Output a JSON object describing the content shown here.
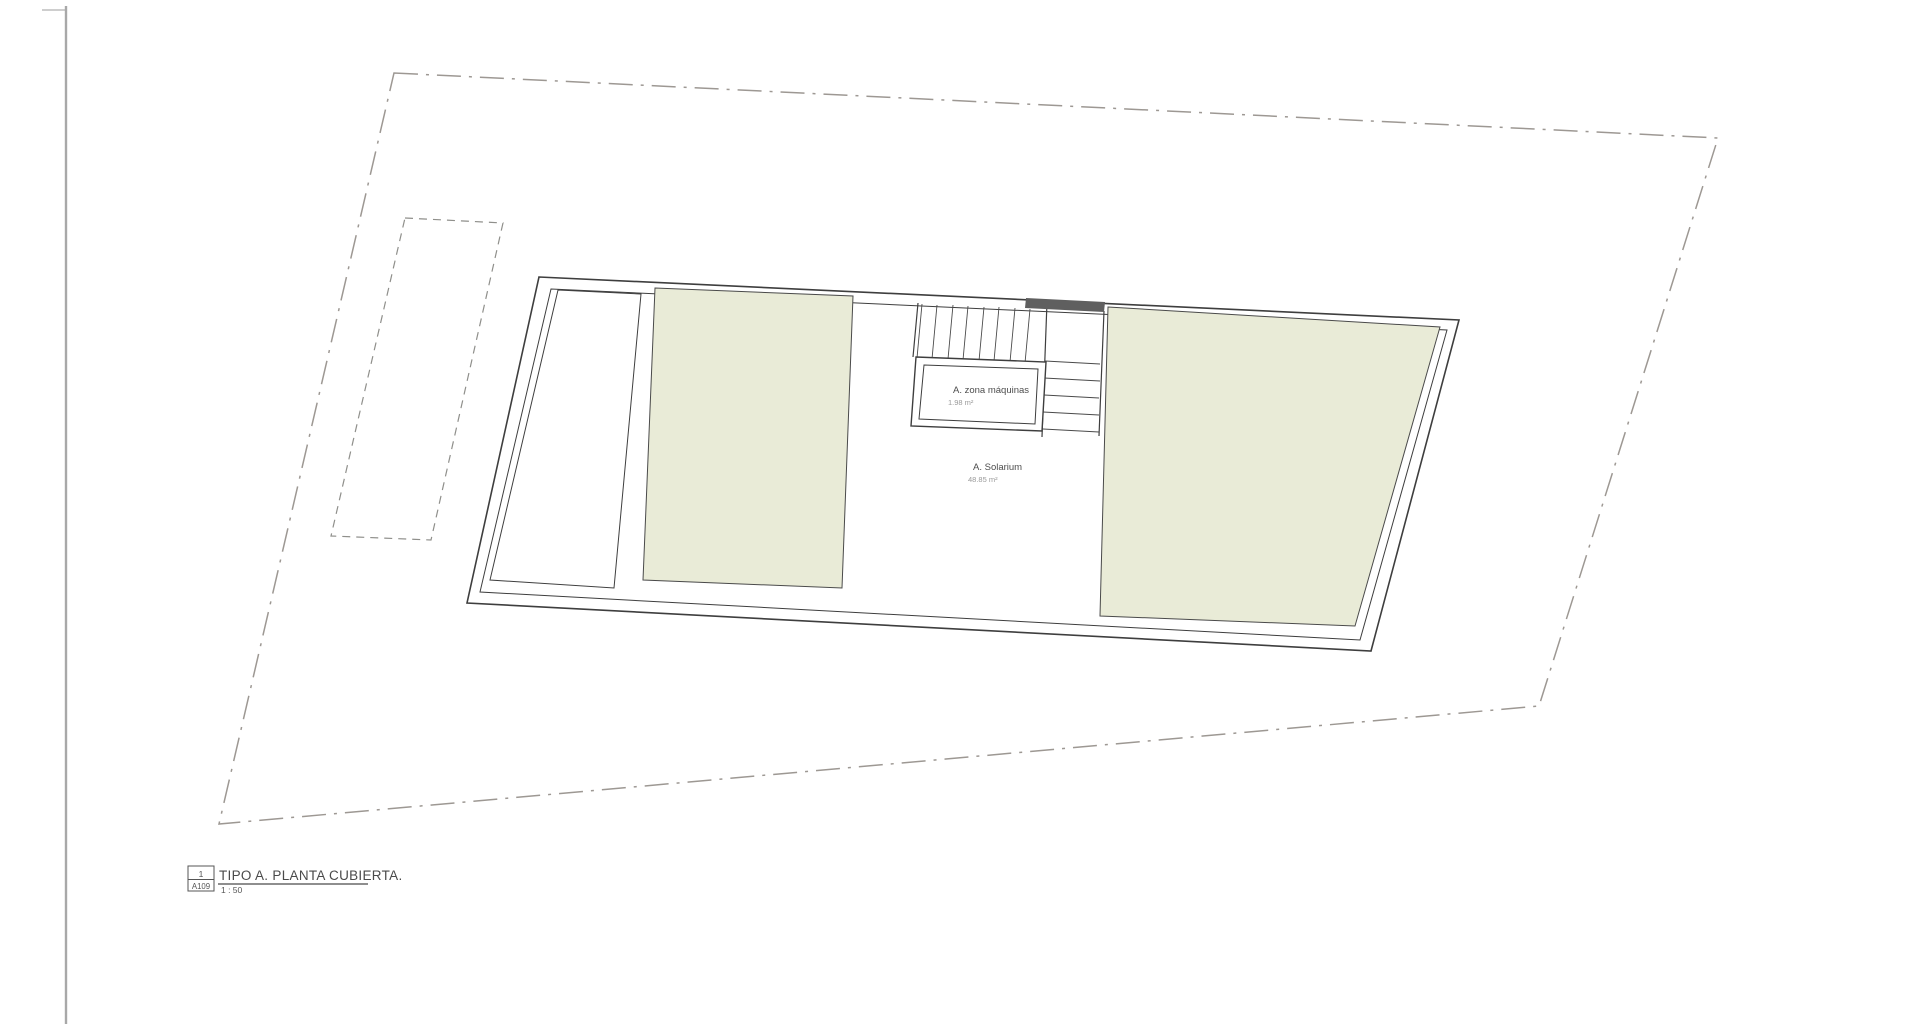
{
  "plan": {
    "rooms": [
      {
        "name": "A. zona máquinas",
        "area": "1.98 m²"
      },
      {
        "name": "A. Solarium",
        "area": "48.85 m²"
      }
    ]
  },
  "title_block": {
    "number": "1",
    "sheet": "A109",
    "title": "TIPO A. PLANTA CUBIERTA.",
    "scale": "1 : 50"
  },
  "colors": {
    "terrace_fill": "#e9ebd7",
    "wall_line": "#3e3e3e",
    "plot_boundary_line": "#9d9893",
    "dashed_outline_line": "#8f8f8b",
    "dark_bar": "#5f5f5f",
    "room_label_text": "#4d4d4d",
    "area_label_text": "#9a9a9a",
    "sheet_edge_line": "#a8a8a8"
  }
}
